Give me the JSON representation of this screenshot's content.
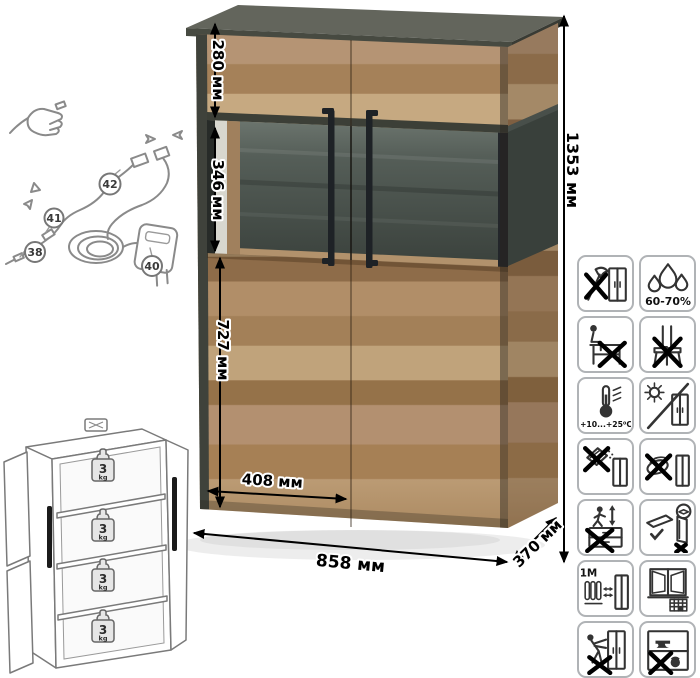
{
  "product_view": {
    "dimensions": {
      "upper_section_height": "280 мм",
      "display_section_height": "346 мм",
      "lower_section_height": "727 мм",
      "door_width": "408 мм",
      "width": "858 мм",
      "depth": "370 мм",
      "height": "1353 мм"
    }
  },
  "wiring_diagram": {
    "callouts": [
      "38",
      "40",
      "41",
      "42"
    ]
  },
  "load_schematic": {
    "shelf_count": 4,
    "shelf_load_value": "3",
    "shelf_load_unit": "kg"
  },
  "care_icons": [
    {
      "name": "no-sharp-tools",
      "label": ""
    },
    {
      "name": "humidity-range",
      "label": "60-70%"
    },
    {
      "name": "no-sitting",
      "label": ""
    },
    {
      "name": "no-standing",
      "label": ""
    },
    {
      "name": "temperature-range",
      "label": "+10...+25⁰C"
    },
    {
      "name": "avoid-direct-sunlight",
      "label": ""
    },
    {
      "name": "no-abrasive-cleaners",
      "label": ""
    },
    {
      "name": "no-wet-cleaning",
      "label": ""
    },
    {
      "name": "no-climbing",
      "label": ""
    },
    {
      "name": "transport-flat-only",
      "label": ""
    },
    {
      "name": "heat-source-distance",
      "label": "≥1М"
    },
    {
      "name": "ventilate-room",
      "label": ""
    },
    {
      "name": "no-pushing",
      "label": ""
    },
    {
      "name": "no-overloading",
      "label": ""
    }
  ],
  "colors": {
    "wood": "#b29070",
    "frame_dark": "#3f423b",
    "glass_back": "#49514b",
    "handle_black": "#1e2226",
    "line_art": "#8a8a8a",
    "tile_border": "#b0b3b6"
  }
}
